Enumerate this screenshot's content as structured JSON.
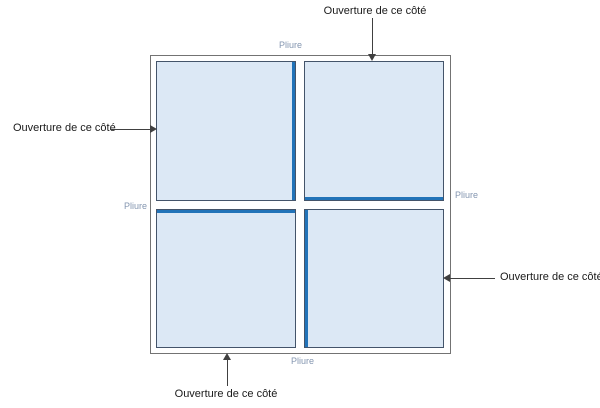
{
  "colors": {
    "panel_fill": "#dce8f5",
    "panel_border": "#44546a",
    "fold_line": "#2273b8",
    "outer_border": "#737373",
    "pliure_text": "#8496b0",
    "label_text": "#1a1a1a",
    "arrow": "#404040"
  },
  "labels": {
    "ouverture_top": "Ouverture de ce côté",
    "ouverture_left": "Ouverture de ce côté",
    "ouverture_right": "Ouverture de ce côté",
    "ouverture_bottom": "Ouverture de ce côté"
  },
  "folds": {
    "pliure_top": "Pliure",
    "pliure_left": "Pliure",
    "pliure_right": "Pliure",
    "pliure_bottom": "Pliure"
  }
}
